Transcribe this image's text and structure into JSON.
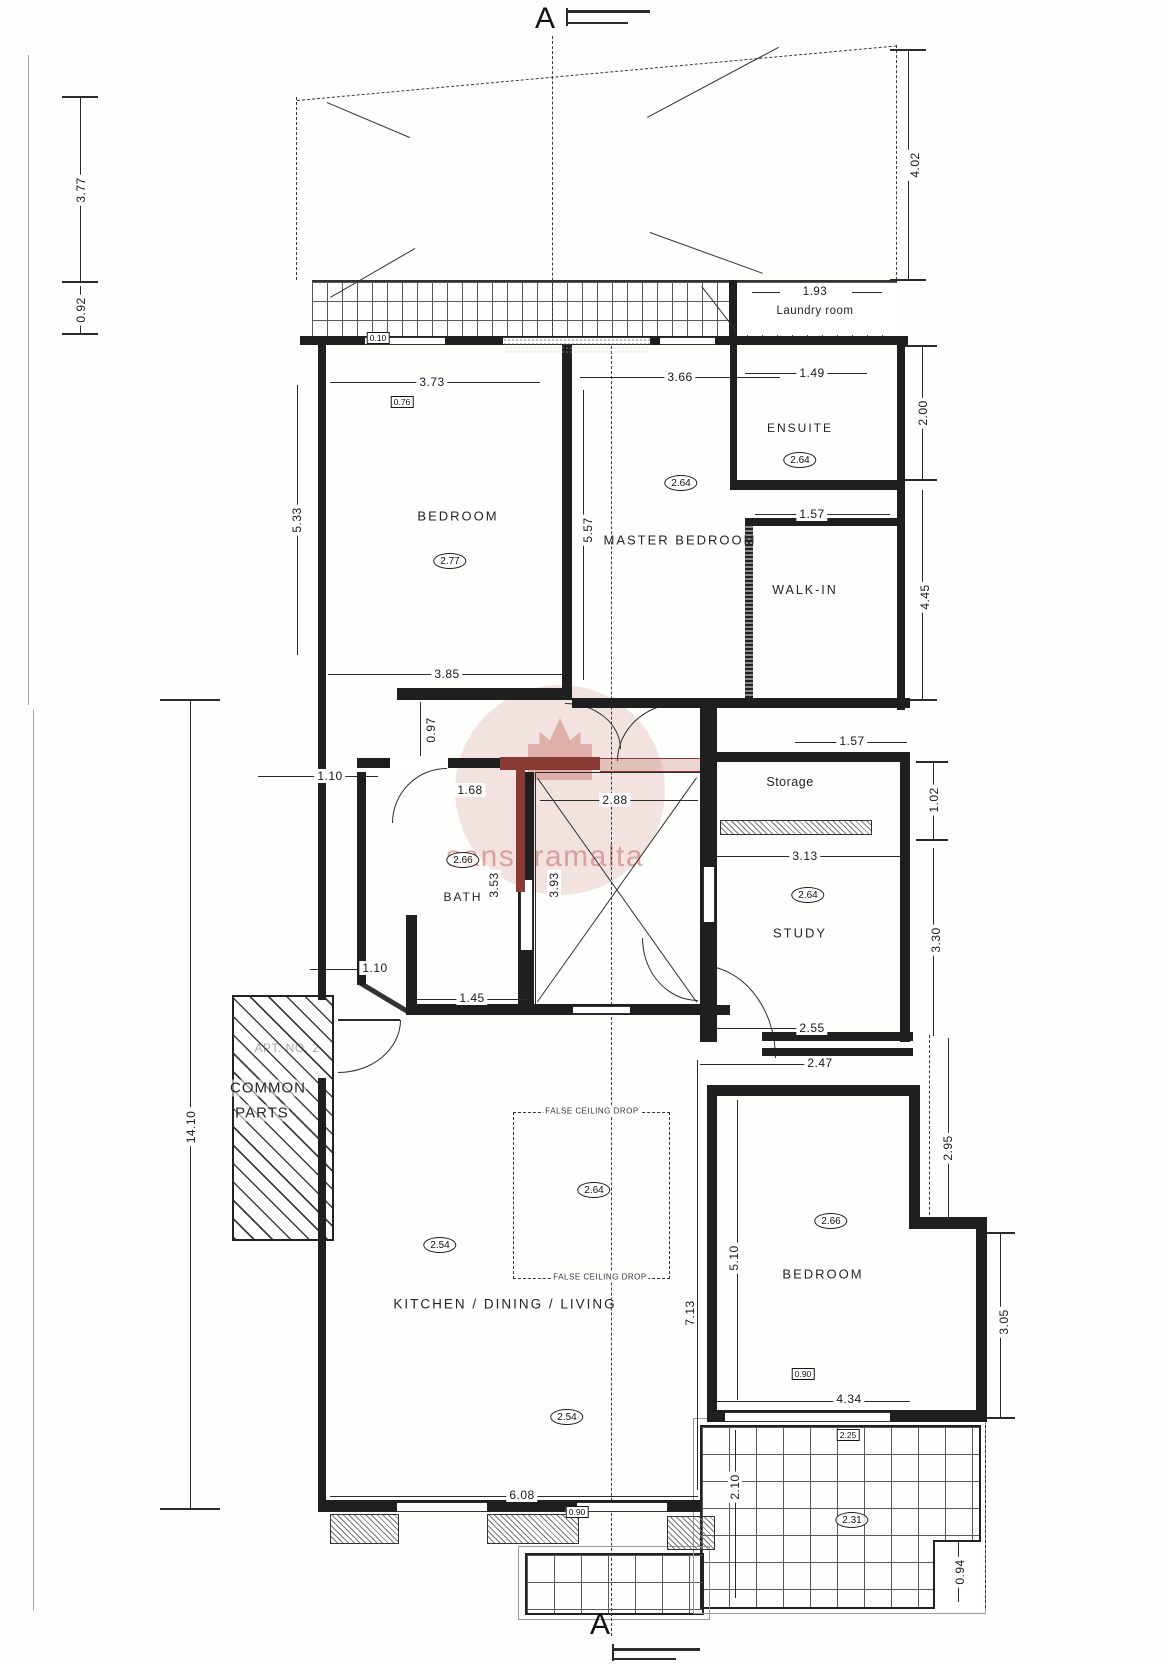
{
  "section_markers": {
    "top": "A",
    "bottom": "A"
  },
  "watermark": {
    "text": "sansaramalta",
    "color": "#c97f7a"
  },
  "rooms": {
    "laundry": {
      "name": "Laundry room"
    },
    "bedroom1": {
      "name": "BEDROOM",
      "ceiling": "2.77",
      "sill": "0.76"
    },
    "master": {
      "name": "MASTER BEDROOM",
      "ceiling": "2.64"
    },
    "ensuite": {
      "name": "ENSUITE",
      "ceiling": "2.64"
    },
    "walkin": {
      "name": "WALK-IN"
    },
    "bath": {
      "name": "BATH",
      "ceiling": "2.66"
    },
    "storage": {
      "name": "Storage"
    },
    "study": {
      "name": "STUDY",
      "ceiling": "2.64"
    },
    "kitchen": {
      "name": "KITCHEN / DINING / LIVING",
      "ceiling_a": "2.54",
      "ceiling_b": "2.54",
      "ceiling_false": "2.64",
      "false_ceiling_label": "FALSE CEILING DROP",
      "sill": "0.90"
    },
    "bedroom2": {
      "name": "BEDROOM",
      "ceiling": "2.66",
      "sill": "0.90"
    },
    "terrace": {
      "ceiling": "2.31",
      "marker": "2.25"
    },
    "common": {
      "line1": "COMMON",
      "line2": "PARTS",
      "apt": "APT. NO. 2"
    },
    "yard": {
      "marker": "0.10"
    }
  },
  "dims": {
    "yard_height": "3.77",
    "yard_depth": "0.92",
    "airspace_right": "4.02",
    "laundry_width": "1.93",
    "bedroom1_top": "3.73",
    "master_top": "3.66",
    "ensuite_width": "1.49",
    "ensuite_depth": "2.00",
    "bedroom1_left": "5.33",
    "bedroom1_right": "5.57",
    "bedroom1_bottom": "3.85",
    "walkin_width": "1.57",
    "walkin_depth": "4.45",
    "hall_drop": "0.97",
    "hall_width_upper": "1.10",
    "hall_width_lower": "1.10",
    "bath_door": "1.68",
    "stair_window": "2.88",
    "bath_depth": "3.53",
    "stair_depth": "3.93",
    "bath_bottom": "1.45",
    "closet_width": "1.57",
    "storage_height": "1.02",
    "storage_width": "3.13",
    "study_height": "3.30",
    "study_bottom": "2.55",
    "bedroom2_offset": "2.47",
    "bedroom2_upper": "2.95",
    "common_length": "14.10",
    "kitchen_width": "6.08",
    "kitchen_height": "7.13",
    "bedroom2_height": "5.10",
    "bedroom2_bottom": "4.34",
    "bedroom2_lower": "3.05",
    "terrace_depth": "2.10",
    "terrace_notch": "0.94"
  }
}
